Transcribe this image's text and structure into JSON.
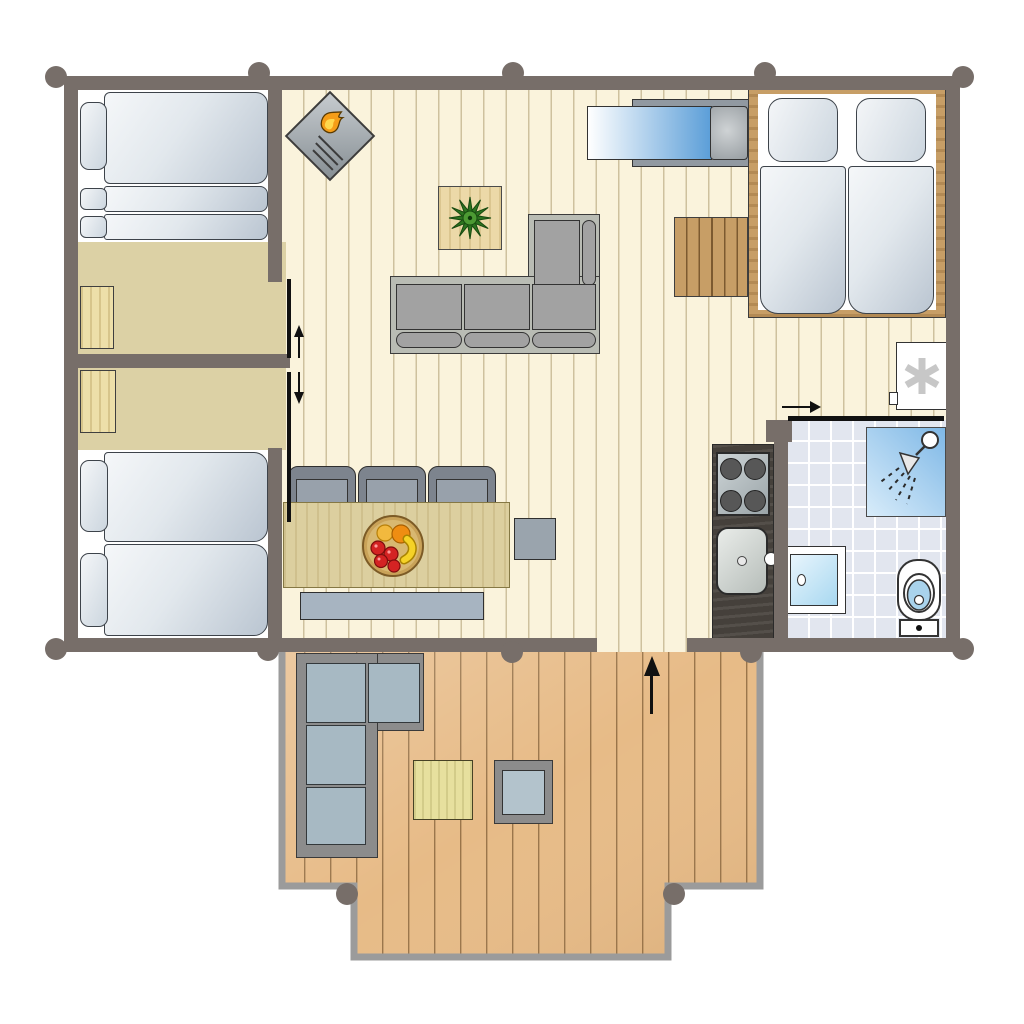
{
  "page": {
    "type": "floor-plan-diagram",
    "background": "#ffffff",
    "description": "Top-down floor plan of a holiday lodge with three sleeping areas, open living room, kitchen corner, bathroom and a large wooden terrace. No text labels are rendered in the drawing."
  },
  "colors": {
    "wall": "#776e69",
    "floor-living": "#faf3dc",
    "floor-bedroom": "#dcd1a5",
    "tile": "#e2e6ef",
    "deck": "#e7bb87",
    "deck-border": "#9b9b9b",
    "wood": "#c79e66",
    "table-wood": "#dccf9f",
    "counter-dark": "#45403b",
    "sofa-frame": "#b9bcb4",
    "outdoor-cushion": "#a7b9c3",
    "water-blue": "#8cc0ea",
    "daybed-blue": "#5b9ed8",
    "flame-orange": "#f59d18",
    "flame-yellow": "#ffd84d",
    "plant-green": "#2c741f",
    "fruit-red": "#d42323",
    "fruit-orange": "#ef8d12",
    "fruit-yellow": "#f5d227"
  },
  "rooms": [
    {
      "name": "bunk-bedroom",
      "position": "top-left",
      "furniture": [
        "bunk-beds",
        "wardrobe"
      ]
    },
    {
      "name": "twin-bedroom",
      "position": "bottom-left",
      "furniture": [
        "twin-bed",
        "twin-bed",
        "wardrobe"
      ]
    },
    {
      "name": "living-room",
      "position": "center",
      "furniture": [
        "wood-stove",
        "corner-sofa",
        "plant-side-table",
        "daybed-cabinet",
        "dining-table",
        "dining-chairs",
        "bench",
        "stool",
        "fruit-bowl"
      ]
    },
    {
      "name": "sleeping-alcove",
      "position": "top-right",
      "furniture": [
        "double-bed",
        "stairs",
        "heater-unit"
      ]
    },
    {
      "name": "kitchen-corner",
      "position": "center-right",
      "furniture": [
        "counter",
        "hob-4-burners",
        "sink"
      ]
    },
    {
      "name": "bathroom",
      "position": "bottom-right",
      "furniture": [
        "shower",
        "washbasin",
        "toilet"
      ]
    },
    {
      "name": "terrace",
      "position": "bottom",
      "furniture": [
        "outdoor-corner-sofa",
        "outdoor-coffee-table",
        "outdoor-table"
      ]
    }
  ],
  "annotations": [
    {
      "name": "entrance-arrow",
      "meaning": "entrance direction into living room from terrace"
    },
    {
      "name": "bedroom-sliding-door-arrows",
      "meaning": "two sliding doors between left bedrooms and living room"
    },
    {
      "name": "bathroom-sliding-door-arrow",
      "meaning": "sliding door across bathroom opening"
    }
  ],
  "icons": [
    "flame-icon",
    "plant-icon",
    "shower-head-icon",
    "fan-asterisk-icon",
    "fruit-bowl-icon",
    "entrance-arrow-icon",
    "slide-arrow-icon"
  ]
}
